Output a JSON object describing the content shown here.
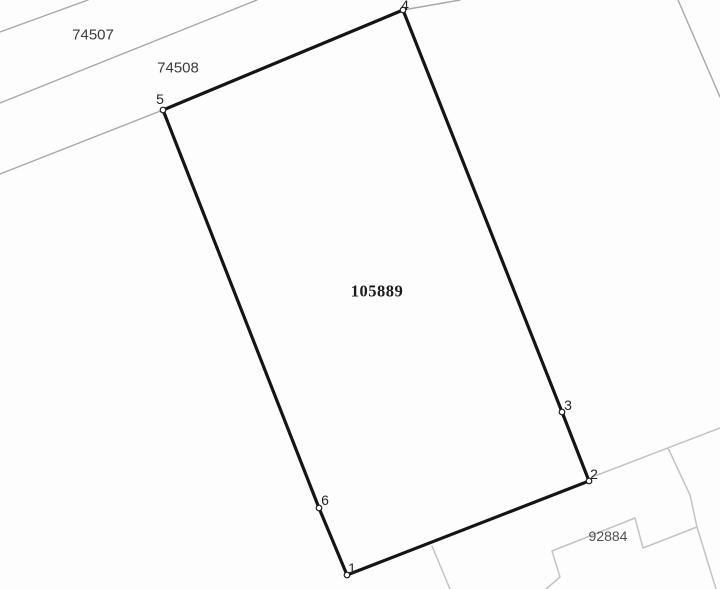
{
  "map": {
    "kind": "cadastral-parcel-map",
    "canvas": {
      "width": 720,
      "height": 589,
      "background": "#fdfdfd"
    },
    "colors": {
      "parcel_stroke": "#151515",
      "neighbor_line_dark": "#a8a8a8",
      "neighbor_line_light": "#c3c3c3",
      "marker_stroke": "#1a1a1a"
    },
    "main_parcel": {
      "number": "105889",
      "label": {
        "text": "105889",
        "x": 377,
        "y": 291
      },
      "stroke_width": 3.2,
      "vertices": [
        {
          "n": "1",
          "x": 347,
          "y": 575,
          "lx": 352,
          "ly": 568
        },
        {
          "n": "2",
          "x": 589,
          "y": 481,
          "lx": 594,
          "ly": 474
        },
        {
          "n": "3",
          "x": 562,
          "y": 412,
          "lx": 568,
          "ly": 405
        },
        {
          "n": "4",
          "x": 403,
          "y": 10,
          "lx": 405,
          "ly": 5
        },
        {
          "n": "5",
          "x": 163,
          "y": 110,
          "lx": 160,
          "ly": 99
        },
        {
          "n": "6",
          "x": 319,
          "y": 508,
          "lx": 325,
          "ly": 500
        }
      ]
    },
    "neighbor_labels": [
      {
        "id": "74507",
        "text": "74507",
        "x": 93,
        "y": 35,
        "style": "lbl-sans"
      },
      {
        "id": "74508",
        "text": "74508",
        "x": 178,
        "y": 68,
        "style": "lbl-sans"
      },
      {
        "id": "92884",
        "text": "92884",
        "x": 608,
        "y": 536,
        "style": "lbl-sans-light"
      }
    ],
    "boundary_lines": [
      {
        "name": "road-edge-upper-left-outer",
        "tone": "dark",
        "width": 1.4,
        "points": [
          [
            0,
            32
          ],
          [
            88,
            0
          ]
        ]
      },
      {
        "name": "road-edge-upper-left-inner",
        "tone": "dark",
        "width": 1.4,
        "points": [
          [
            0,
            103
          ],
          [
            257,
            0
          ]
        ]
      },
      {
        "name": "road-edge-along-parcel",
        "tone": "dark",
        "width": 1.4,
        "points": [
          [
            0,
            174
          ],
          [
            163,
            110
          ],
          [
            403,
            10
          ],
          [
            460,
            0
          ]
        ]
      },
      {
        "name": "boundary-top-right-corner",
        "tone": "dark",
        "width": 1.4,
        "points": [
          [
            678,
            0
          ],
          [
            720,
            97
          ]
        ]
      },
      {
        "name": "road-edge-lower-right",
        "tone": "light",
        "width": 1.5,
        "points": [
          [
            592,
            477
          ],
          [
            720,
            428
          ]
        ]
      },
      {
        "name": "neighbor-boundary-east",
        "tone": "light",
        "width": 1.5,
        "points": [
          [
            668,
            448
          ],
          [
            690,
            495
          ],
          [
            697,
            527
          ],
          [
            716,
            589
          ]
        ]
      },
      {
        "name": "parcel-92884-boundary",
        "tone": "light",
        "width": 1.5,
        "points": [
          [
            546,
            589
          ],
          [
            560,
            577
          ],
          [
            552,
            551
          ],
          [
            635,
            518
          ],
          [
            643,
            548
          ],
          [
            697,
            527
          ]
        ]
      },
      {
        "name": "neighbor-boundary-south",
        "tone": "light",
        "width": 1.5,
        "points": [
          [
            432,
            546
          ],
          [
            450,
            589
          ]
        ]
      }
    ]
  }
}
